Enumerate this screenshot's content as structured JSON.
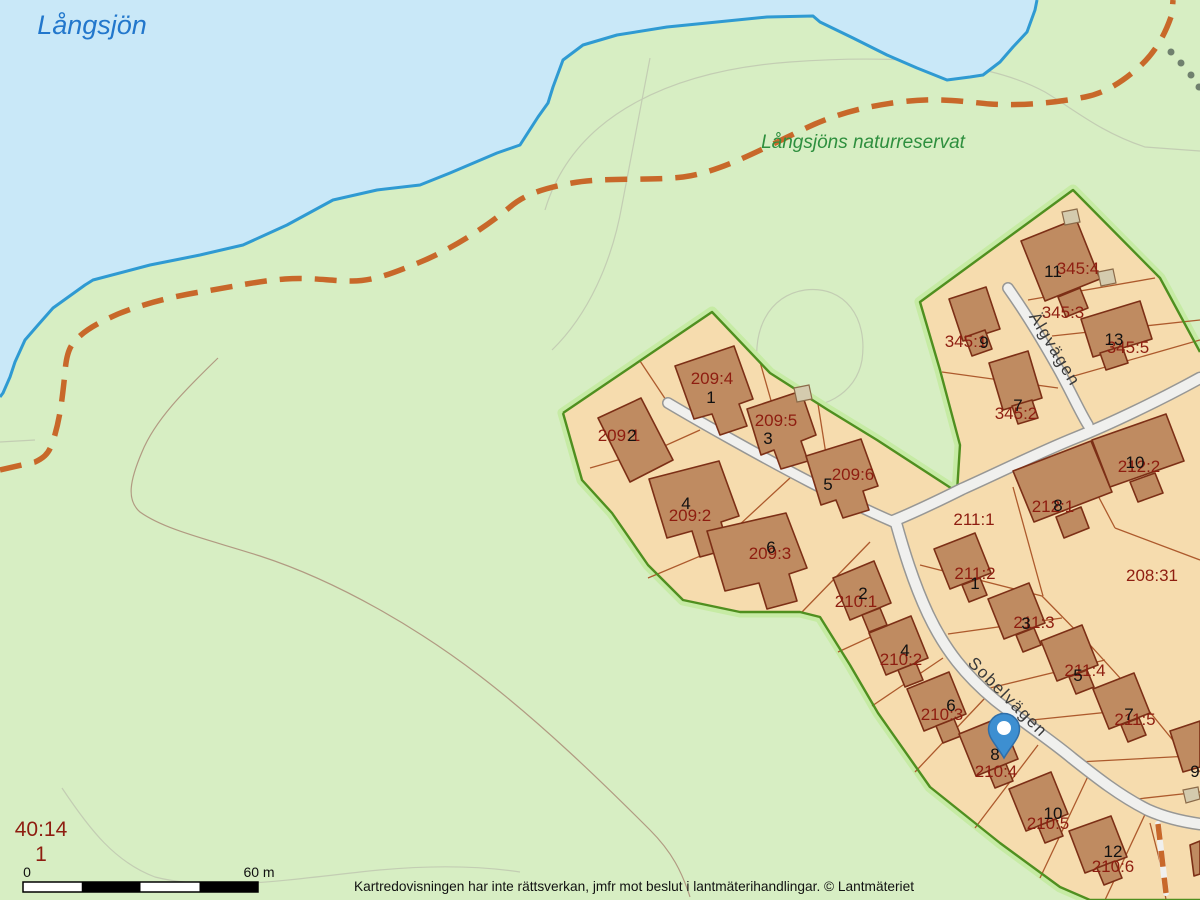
{
  "map": {
    "labels": {
      "water": "Långsjön",
      "reserve": "Långsjöns naturreservat",
      "streets": [
        "Älgvägen",
        "Sobelvägen"
      ],
      "parcels": [
        "209:1",
        "209:4",
        "209:5",
        "209:6",
        "209:2",
        "209:3",
        "210:1",
        "210:2",
        "210:3",
        "210:4",
        "210:5",
        "210:6",
        "211:1",
        "211:2",
        "211:3",
        "211:4",
        "211:5",
        "212:1",
        "212:2",
        "208:31",
        "345:1",
        "345:2",
        "345:3",
        "345:4",
        "345:5",
        "40:14",
        "1"
      ],
      "house_numbers": [
        "2",
        "1",
        "3",
        "5",
        "4",
        "6",
        "2",
        "4",
        "6",
        "8",
        "10",
        "12",
        "1",
        "3",
        "5",
        "7",
        "9",
        "8",
        "10",
        "9",
        "7",
        "11",
        "13"
      ]
    },
    "scalebar": {
      "zero": "0",
      "end": "60 m"
    },
    "footer": "Kartredovisningen har inte rättsverkan, jmfr mot beslut i lantmäterihandlingar. © Lantmäteriet",
    "marker": {
      "type": "location-pin"
    },
    "colors": {
      "water_fill": "#c9e8f8",
      "shoreline": "#2f9ad2",
      "land": "#d7eec3",
      "reserve_line": "#4f8f1f",
      "reserve_glow": "#c6eba4",
      "parcel_fill": "#f6dcae",
      "parcel_line": "#ad5a2d",
      "building": "#bf8b61",
      "building_outline": "#7c2f16",
      "road_fill": "#f0f0ee",
      "road_casing": "#979795",
      "trail": "#c8682a",
      "dotted_path": "#70806e",
      "label_red": "#8e1d10",
      "marker_blue": "#3d8fd1"
    }
  }
}
